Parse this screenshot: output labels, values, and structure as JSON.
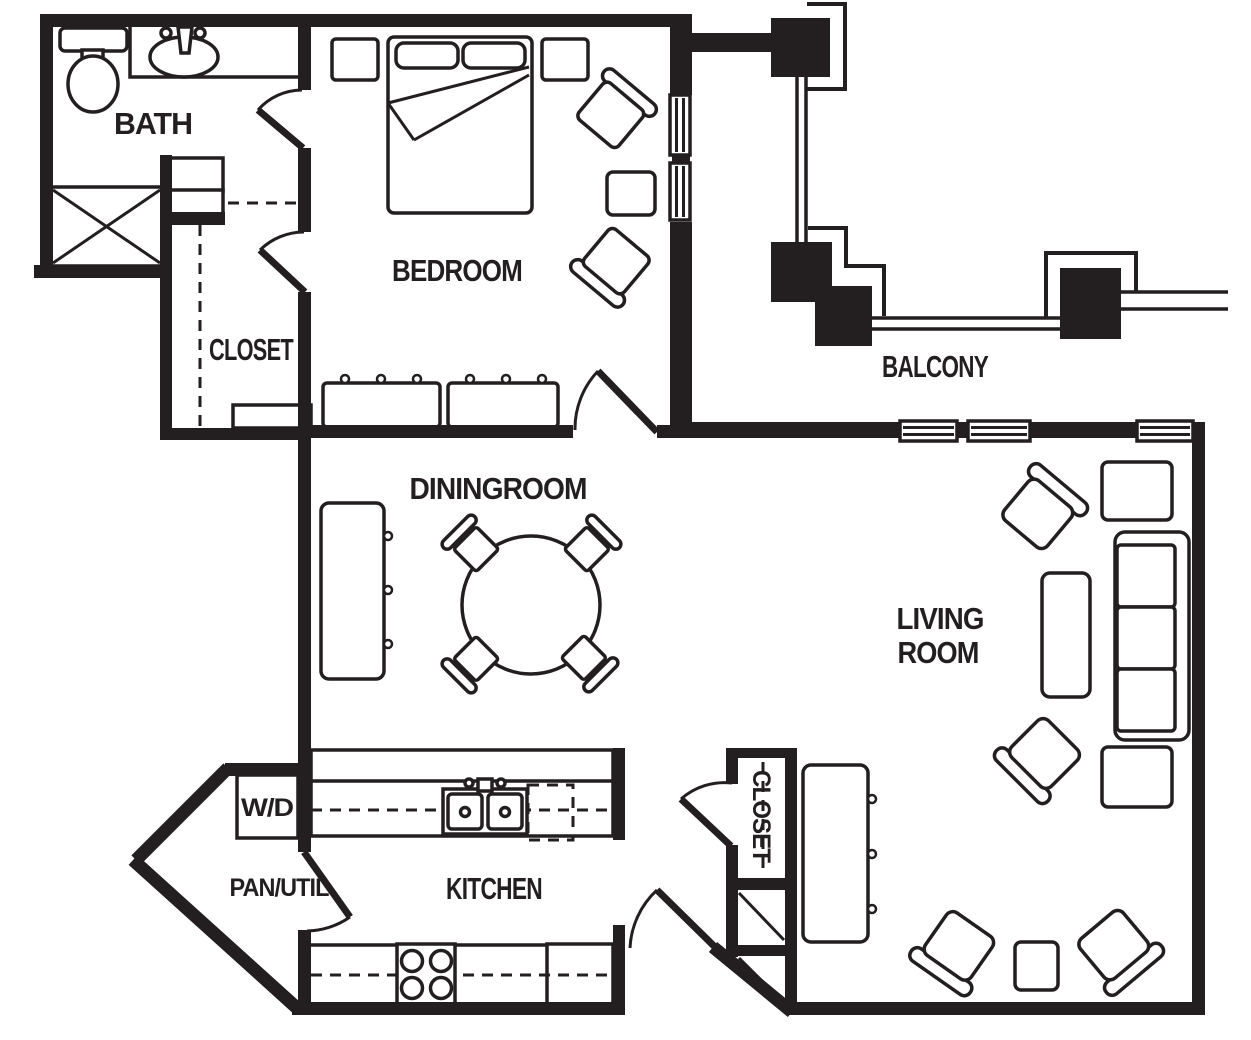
{
  "plan": {
    "type": "apartment-floor-plan",
    "colors": {
      "ink": "#231f20",
      "background": "#ffffff"
    },
    "rooms": {
      "bath": {
        "label": "BATH"
      },
      "bedroom": {
        "label": "BEDROOM"
      },
      "bedroom_closet": {
        "label": "CLOSET"
      },
      "balcony": {
        "label": "BALCONY"
      },
      "dining": {
        "label": "DININGROOM"
      },
      "living": {
        "label_line1": "LIVING",
        "label_line2": "ROOM"
      },
      "kitchen": {
        "label": "KITCHEN"
      },
      "pantry": {
        "label": "PAN/UTIL"
      },
      "washer_dryer": {
        "label": "W/D"
      },
      "hall_closet": {
        "label": "CLOSET"
      }
    }
  }
}
